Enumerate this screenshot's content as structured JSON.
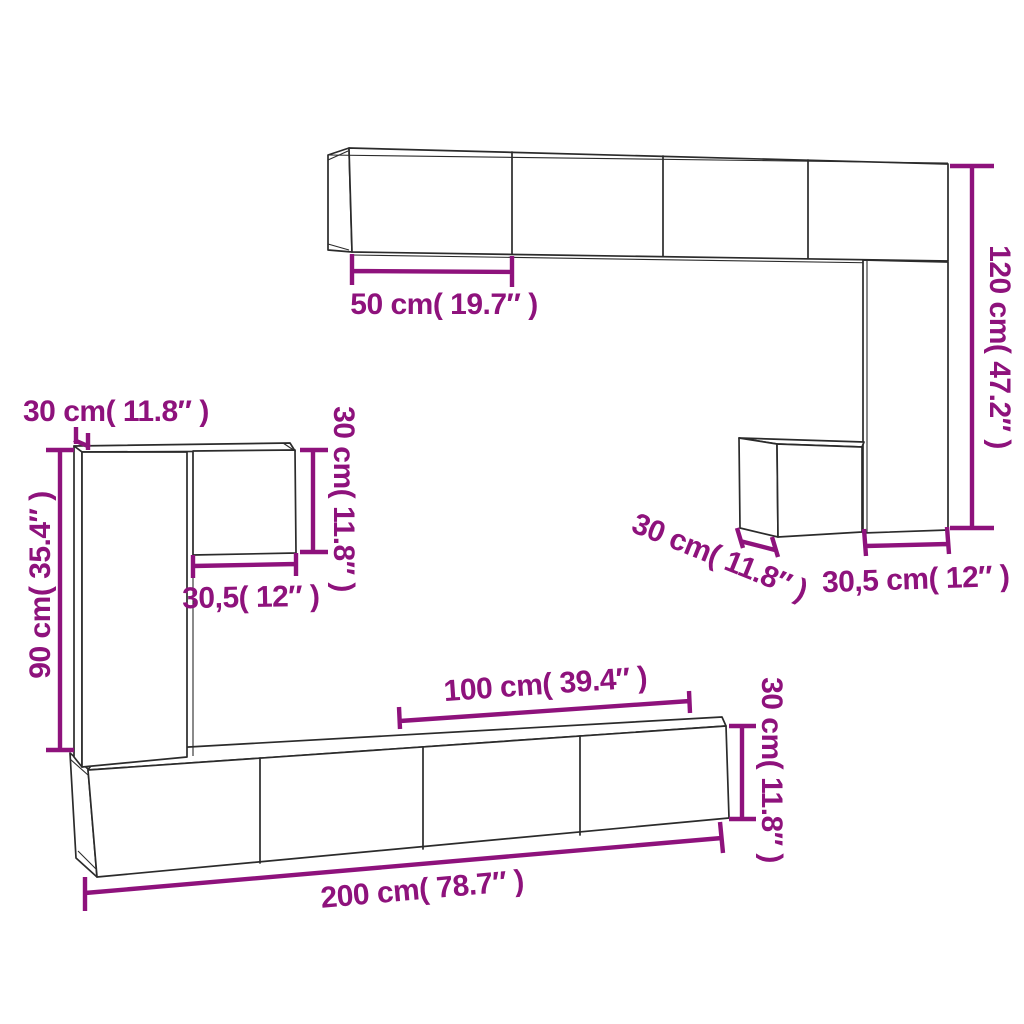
{
  "diagram": {
    "kind": "furniture dimension line drawing",
    "colors": {
      "dimension_accent": "#8E127C",
      "outline": "#2b2b2b",
      "background": "#ffffff"
    },
    "labels": {
      "top_shelf_door_width": "50 cm( 19.7″  )",
      "right_column_height": "120 cm( 47.2″  )",
      "left_top_depth": "30 cm( 11.8″  )",
      "left_square_height": "30 cm( 11.8″  )",
      "left_square_width": "30,5( 12″  )",
      "left_column_height": "90 cm( 35.4″  )",
      "right_cube_depth": "30 cm( 11.8″  )",
      "right_column_width": "30,5 cm( 12″  )",
      "bottom_section_width": "100 cm( 39.4″  )",
      "bottom_cabinet_height": "30 cm( 11.8″  )",
      "bottom_total_width": "200 cm( 78.7″  )"
    }
  }
}
